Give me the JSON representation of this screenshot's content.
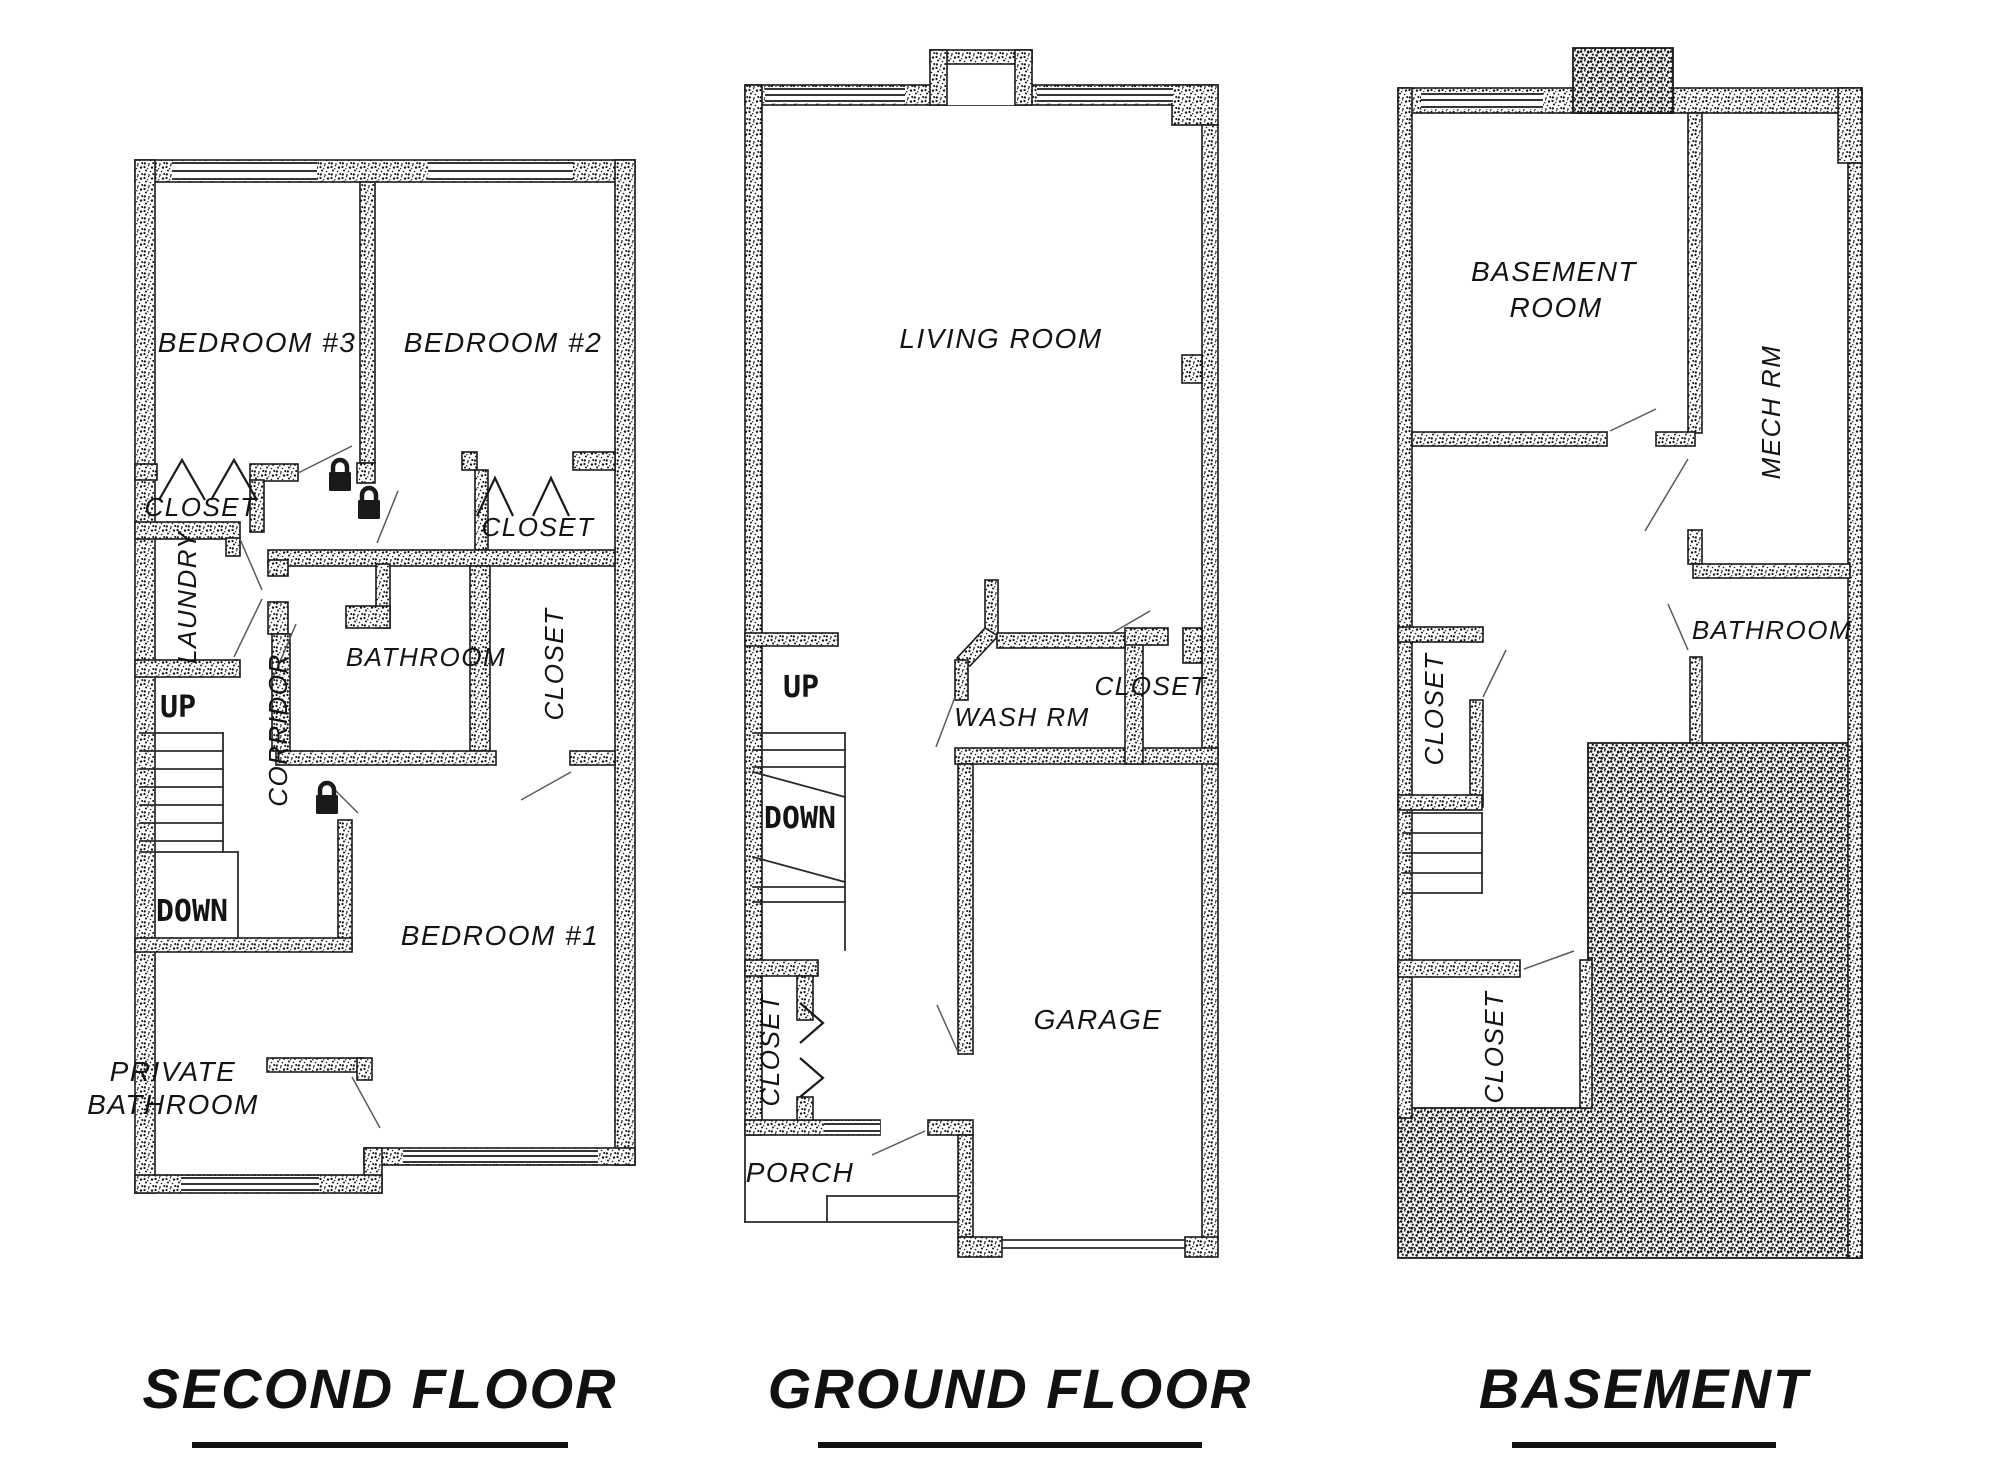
{
  "sheet": {
    "background": "#ffffff",
    "ink": "#1a1a1a"
  },
  "icons": {
    "padlock": "padlock-icon",
    "door_swing": "door-leaf-line",
    "folding_door": "chevron-door-symbol",
    "window": "window-symbol",
    "stairs": "stair-treads"
  },
  "floors": [
    {
      "id": "sf",
      "title": "SECOND FLOOR",
      "labels": [
        {
          "text": "BEDROOM #3",
          "x": 257,
          "y": 352,
          "size": 28
        },
        {
          "text": "BEDROOM #2",
          "x": 503,
          "y": 352,
          "size": 28
        },
        {
          "text": "CLOSET",
          "x": 201,
          "y": 516,
          "size": 26
        },
        {
          "text": "LAUNDRY",
          "x": 196,
          "y": 597,
          "size": 26,
          "rot": -90
        },
        {
          "text": "CORRIDOR",
          "x": 287,
          "y": 730,
          "size": 26,
          "rot": -90
        },
        {
          "text": "BATHROOM",
          "x": 426,
          "y": 666,
          "size": 26
        },
        {
          "text": "CLOSET",
          "x": 538,
          "y": 536,
          "size": 26
        },
        {
          "text": "CLOSET",
          "x": 563,
          "y": 664,
          "size": 26,
          "rot": -90
        },
        {
          "text": "UP",
          "x": 178,
          "y": 717,
          "size": 30,
          "cls": "tech"
        },
        {
          "text": "DOWN",
          "x": 192,
          "y": 921,
          "size": 30,
          "cls": "tech"
        },
        {
          "text": "BEDROOM #1",
          "x": 500,
          "y": 945,
          "size": 28
        },
        {
          "text": "PRIVATE",
          "x": 173,
          "y": 1081,
          "size": 28,
          "anchor": "start"
        },
        {
          "text": "BATHROOM",
          "x": 173,
          "y": 1114,
          "size": 28,
          "anchor": "start"
        }
      ],
      "locks": [
        {
          "x": 340,
          "y": 476
        },
        {
          "x": 369,
          "y": 504
        },
        {
          "x": 327,
          "y": 799
        }
      ]
    },
    {
      "id": "gf",
      "title": "GROUND FLOOR",
      "labels": [
        {
          "text": "LIVING ROOM",
          "x": 1001,
          "y": 348,
          "size": 28
        },
        {
          "text": "UP",
          "x": 801,
          "y": 697,
          "size": 30,
          "cls": "tech"
        },
        {
          "text": "DOWN",
          "x": 800,
          "y": 828,
          "size": 30,
          "cls": "tech"
        },
        {
          "text": "WASH RM",
          "x": 1022,
          "y": 726,
          "size": 26
        },
        {
          "text": "CLOSET",
          "x": 1151,
          "y": 695,
          "size": 26
        },
        {
          "text": "GARAGE",
          "x": 1098,
          "y": 1029,
          "size": 28
        },
        {
          "text": "CLOSET",
          "x": 779,
          "y": 1050,
          "size": 26,
          "rot": -90
        },
        {
          "text": "PORCH",
          "x": 800,
          "y": 1182,
          "size": 28
        }
      ],
      "locks": []
    },
    {
      "id": "bs",
      "title": "BASEMENT",
      "labels": [
        {
          "text": "BASEMENT",
          "x": 1554,
          "y": 281,
          "size": 28
        },
        {
          "text": "ROOM",
          "x": 1556,
          "y": 317,
          "size": 28
        },
        {
          "text": "MECH RM",
          "x": 1780,
          "y": 412,
          "size": 26,
          "rot": -90
        },
        {
          "text": "BATHROOM",
          "x": 1772,
          "y": 639,
          "size": 26
        },
        {
          "text": "CLOSET",
          "x": 1443,
          "y": 709,
          "size": 26,
          "rot": -90
        },
        {
          "text": "CLOSET",
          "x": 1503,
          "y": 1047,
          "size": 26,
          "rot": -90
        }
      ],
      "locks": []
    }
  ]
}
